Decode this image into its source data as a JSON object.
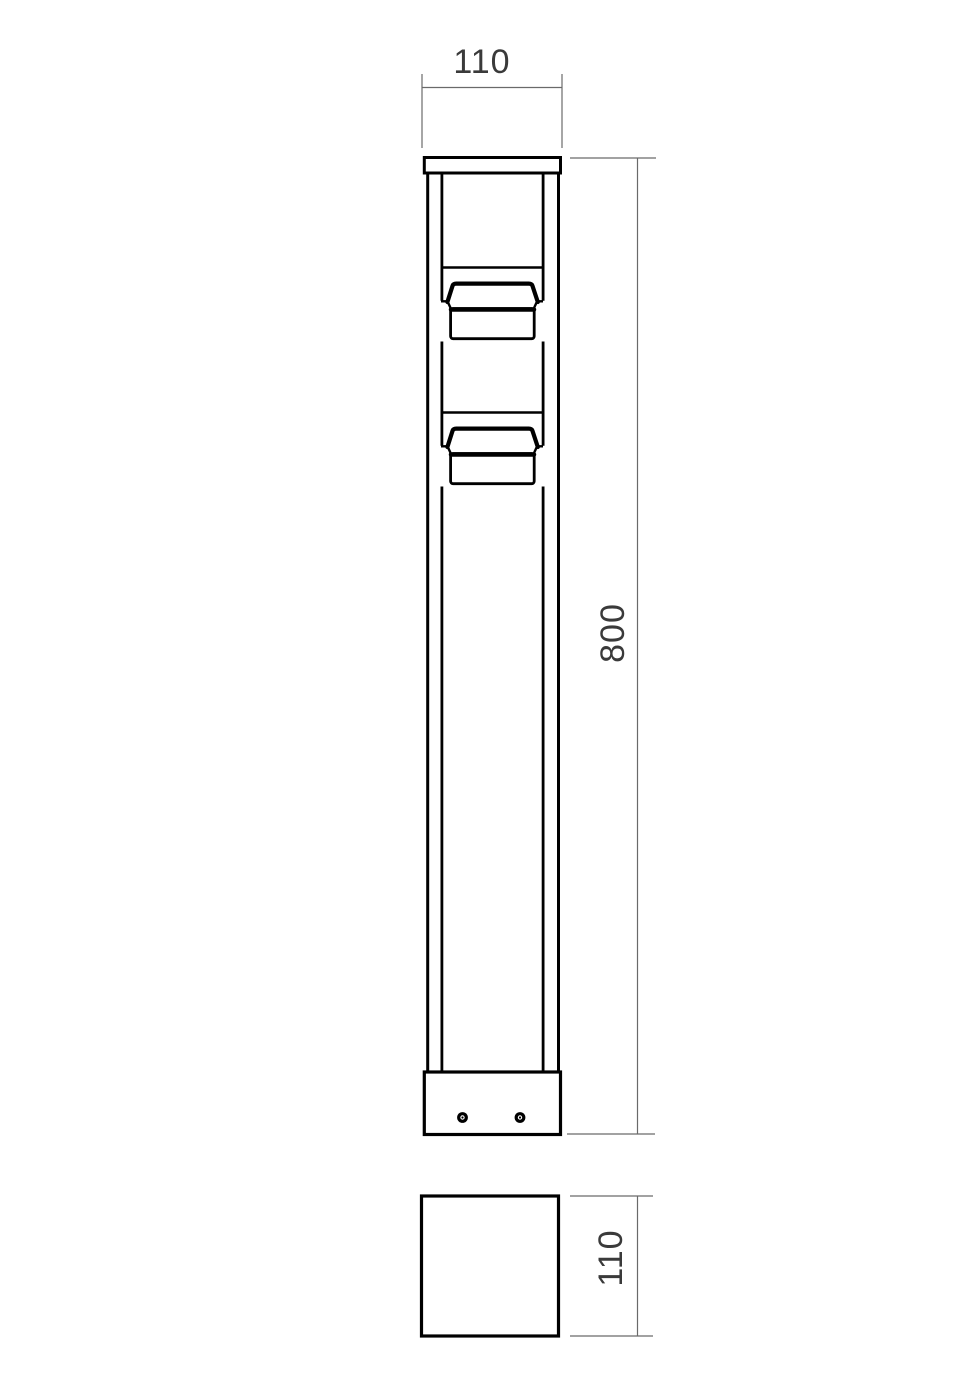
{
  "drawing": {
    "dimensions": {
      "front_width": "110",
      "front_height": "800",
      "base_side": "110"
    },
    "colors": {
      "object_line": "#000000",
      "dimension_line": "#6a6a6a",
      "dimension_text": "#3a3a3a",
      "background": "#ffffff"
    }
  }
}
